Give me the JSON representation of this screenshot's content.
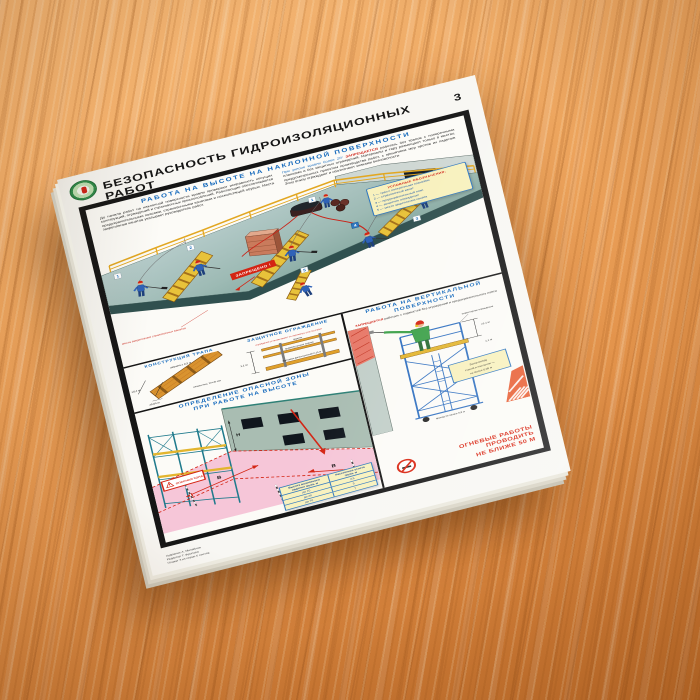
{
  "poster": {
    "page_number": "3",
    "title": "БЕЗОПАСНОСТЬ ГИДРОИЗОЛЯЦИОННЫХ РАБОТ",
    "credits": [
      "Художник А. Михайлов",
      "Редактор Т. Фролова",
      "Плакат 3 из серии 5 листов"
    ]
  },
  "panel_incline": {
    "title": "РАБОТА НА ВЫСОТЕ НА НАКЛОННОЙ ПОВЕРХНОСТИ",
    "para1": "До начала работ на наклонной поверхности кровли проверяют исправность несущих конструкций, ограждений и страховочных приспособлений. Работающие обеспечиваются предохранительными поясами, страховочными канатами и нескользящей обувью. Места закрепления канатов указывает руководитель работ.",
    "para2_blue": "При уклоне кровли более 20°",
    "para2_red": " ЗАПРЕЩАЕТСЯ ",
    "para2_rest": "работать без трапов с поперечными планками и без защитных ограждений. Материалы и тару размещают только в местах, предусмотренных проектом производства работ, с принятием мер против их падения. Зону внизу ограждают и обозначают знаками безопасности.",
    "forbidden_label": "ЗАПРЕЩЕНО !",
    "anchor_label": "места закрепления страховочных канатов",
    "tags": [
      "1",
      "2",
      "3",
      "4",
      "5",
      "1"
    ],
    "legend": {
      "title": "УСЛОВНЫЕ ОБОЗНАЧЕНИЯ:",
      "items": [
        "1 — трап с поперечными планками",
        "2 — страховочный канат",
        "3 — предохранительный пояс",
        "4 — защитное ограждение",
        "5 — место закрепления каната"
      ]
    }
  },
  "detail_trap": {
    "title": "КОНСТРУКЦИЯ ТРАПА",
    "dim_width": "ширина ≥ 0,3 м",
    "dim_step": "≥0,4 м",
    "plank": "планки мин. 20×40 мм",
    "dim_gap": "≥0,04 м"
  },
  "detail_rail": {
    "title": "ЗАЩИТНОЕ ОГРАЖДЕНИЕ",
    "note_red": "ограждение устанавливают по периметру участка работ",
    "handrail": "перила",
    "midrail": "промежуточная планка",
    "toeboard": "бортовая доска высотой 0,15 м",
    "height": "1,1 м"
  },
  "panel_zone": {
    "title_line1": "ОПРЕДЕЛЕНИЕ ОПАСНОЙ ЗОНЫ",
    "title_line2": "ПРИ РАБОТЕ НА ВЫСОТЕ",
    "sign": "ОПАСНАЯ ЗОНА",
    "dim": "В",
    "height_dim": "Н",
    "table": {
      "col1": "Высота возможного падения груза, м",
      "col2": "Расстояние отлета груза, м",
      "rows": [
        [
          "до 10",
          "3,5"
        ],
        [
          "до 20",
          "5"
        ],
        [
          "до 70",
          "7"
        ]
      ]
    }
  },
  "panel_vertical": {
    "title_line1": "РАБОТА НА ВЕРТИКАЛЬНОЙ",
    "title_line2": "ПОВЕРХНОСТИ",
    "warning_red": "ЗАПРЕЩАЕТСЯ",
    "warning_rest": "работать с подмостей без ограждений и предохранительного пояса",
    "rail_label": "инвентарное ограждение",
    "dim1": "≥1,1 м",
    "dim2": "1,1 м",
    "note_l1": "Зазор между",
    "note_l2": "стеной и настилом —",
    "note_l3": "не более 0,05 м",
    "pass_label": "проход не менее 0,6 м",
    "fire_line1": "ОГНЕВЫЕ РАБОТЫ",
    "fire_line2": "ПРОВОДИТЬ",
    "fire_line3": "НЕ БЛИЖЕ 50 М"
  }
}
